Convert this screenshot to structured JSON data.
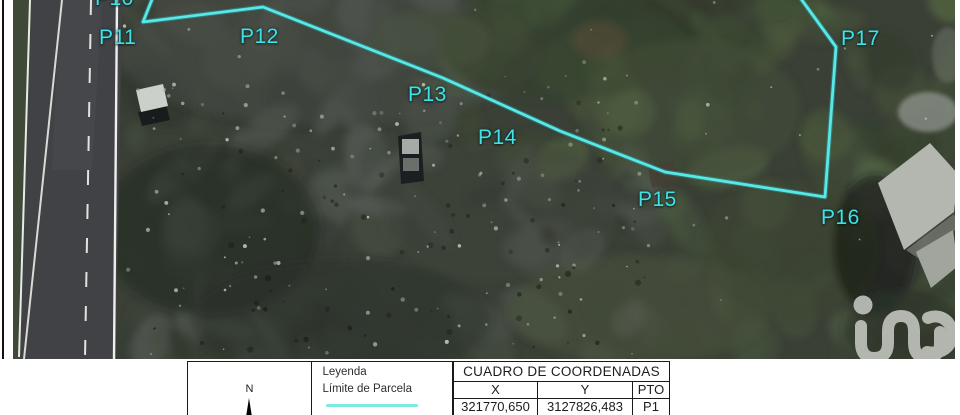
{
  "map": {
    "boundary_color": "#58e8e8",
    "boundary_glow_color": "#2aa9ad",
    "boundary_points": "155,-8 143,22 263,7 443,78 560,131 665,172 825,197 836,47 796,-8",
    "point_labels": [
      {
        "label": "P10",
        "x": 95,
        "y": -13
      },
      {
        "label": "P11",
        "x": 99,
        "y": 26
      },
      {
        "label": "P12",
        "x": 240,
        "y": 25
      },
      {
        "label": "P13",
        "x": 408,
        "y": 83
      },
      {
        "label": "P14",
        "x": 478,
        "y": 126
      },
      {
        "label": "P15",
        "x": 638,
        "y": 188
      },
      {
        "label": "P16",
        "x": 821,
        "y": 206
      },
      {
        "label": "P17",
        "x": 841,
        "y": 27
      }
    ]
  },
  "legend": {
    "title": "Leyenda",
    "item_label": "Límite de Parcela",
    "line_color": "#7de9e2"
  },
  "north": {
    "label": "N"
  },
  "coordinates_table": {
    "title": "CUADRO DE COORDENADAS",
    "columns": [
      "X",
      "Y",
      "PTO"
    ],
    "rows": [
      [
        "321770,650",
        "3127826,483",
        "P1"
      ]
    ]
  },
  "watermark": {
    "icon": "iad-logo",
    "color": "#c9cdc7"
  }
}
